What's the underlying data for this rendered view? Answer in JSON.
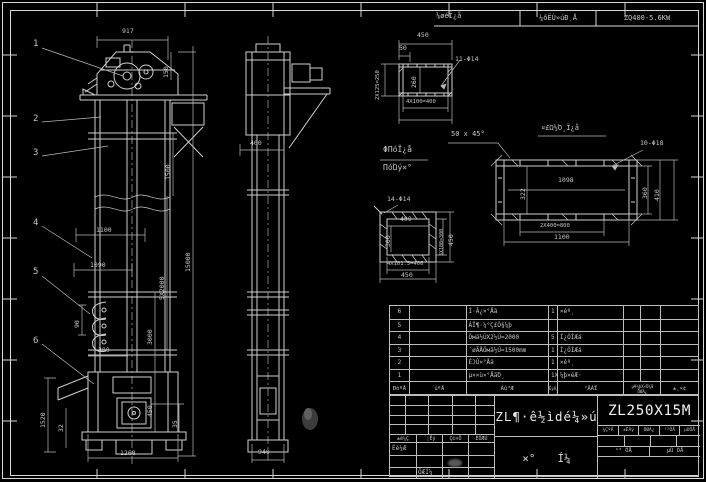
{
  "colors": {
    "background": "#000000",
    "line": "#d0d0d0",
    "dim_text": "#c6c6c6",
    "bright_text": "#f0f0f0"
  },
  "top_strip": {
    "note_left": "⅛øéÏ¿å",
    "gearbox_label": "¼õËÙ»úÐͺÅ",
    "gearbox_model": "ZQ400-5.6KW"
  },
  "parts_table": {
    "headers": {
      "no": "ÐòºÅ",
      "code": "´úºÅ",
      "name": "Ãû³Æ",
      "qty": "ÊýÁ¿",
      "material": "²ÄÁÏ",
      "weight_top": "µ¥¼þX×Ü¼Æ",
      "weight_bottom": "ÖØÁ¿",
      "remark": "±¸×¢"
    },
    "rows": [
      {
        "no": "6",
        "code": "",
        "name": "Í·Â¿×°Åä",
        "qty": "1",
        "material": "×éº¸",
        "remark": ""
      },
      {
        "no": "5",
        "code": "",
        "name": "ÁÏ¶·¼°Ç£Ò§¼þ",
        "qty": "",
        "material": "",
        "remark": ""
      },
      {
        "no": "4",
        "code": "",
        "name": "Öмä½ÚX2½Ú=2000",
        "qty": "5",
        "material": "Í¿ÓÍÆá",
        "remark": ""
      },
      {
        "no": "3",
        "code": "",
        "name": "´øÃÅÖмä½Ú=1500mm",
        "qty": "1",
        "material": "Í¿ÓÍÆá",
        "remark": ""
      },
      {
        "no": "2",
        "code": "",
        "name": "ÉϽÚ×°Åä",
        "qty": "1",
        "material": "×éº¸",
        "remark": ""
      },
      {
        "no": "1",
        "code": "",
        "name": "µ××ù×°ÅäΌ¸",
        "qty": "1X",
        "material": "¼þ×éÆ·",
        "remark": ""
      }
    ]
  },
  "title_block": {
    "rev_labels": [
      "±ê¼Ç",
      "´¦Êý",
      "Ç©×Ö",
      "ÈÕÆÚ"
    ],
    "designer_label": "Éè¼Æ",
    "draft_label": "ÖÆÍ¼",
    "title": "ZL¶·ê½ìdé¼»ú",
    "char_left": "×°",
    "char_right": "Í¼",
    "model": "ZL250X15M",
    "info_cells": [
      "¼ÇºÅ",
      "±ÈÀý",
      "ÖØÁ¿",
      "¹²ÕÅ",
      "µÚÕÅ"
    ],
    "sheet_left": "¹² ÕÅ",
    "sheet_right": "µÚ ÕÅ"
  },
  "annotations": [
    {
      "name": "balloon-1",
      "text": "1",
      "x": 33,
      "y": 40,
      "fs": 9
    },
    {
      "name": "balloon-2",
      "text": "2",
      "x": 33,
      "y": 115,
      "fs": 9
    },
    {
      "name": "balloon-3",
      "text": "3",
      "x": 33,
      "y": 149,
      "fs": 9
    },
    {
      "name": "balloon-4",
      "text": "4",
      "x": 33,
      "y": 219,
      "fs": 9
    },
    {
      "name": "balloon-5",
      "text": "5",
      "x": 33,
      "y": 268,
      "fs": 9
    },
    {
      "name": "balloon-6",
      "text": "6",
      "x": 33,
      "y": 337,
      "fs": 9
    },
    {
      "name": "dim-917",
      "text": "917",
      "x": 122,
      "y": 28
    },
    {
      "name": "dim-150",
      "text": "150",
      "x": 163,
      "y": 78,
      "rot": 1
    },
    {
      "name": "dim-1500",
      "text": "1500",
      "x": 165,
      "y": 180,
      "rot": 1
    },
    {
      "name": "dim-15000",
      "text": "15000",
      "x": 185,
      "y": 272,
      "rot": 1
    },
    {
      "name": "dim-5x2000",
      "text": "5X2000",
      "x": 159,
      "y": 300,
      "rot": 1
    },
    {
      "name": "dim-3000",
      "text": "3000",
      "x": 147,
      "y": 345,
      "rot": 1
    },
    {
      "name": "dim-450-front",
      "text": "450",
      "x": 147,
      "y": 417,
      "rot": 1
    },
    {
      "name": "dim-35",
      "text": "35",
      "x": 172,
      "y": 428,
      "rot": 1
    },
    {
      "name": "dim-1100",
      "text": "1100",
      "x": 96,
      "y": 227
    },
    {
      "name": "dim-1090",
      "text": "1090",
      "x": 90,
      "y": 262
    },
    {
      "name": "dim-90",
      "text": "90",
      "x": 74,
      "y": 328,
      "rot": 1
    },
    {
      "name": "dim-300",
      "text": "300",
      "x": 98,
      "y": 347
    },
    {
      "name": "dim-1520",
      "text": "1520",
      "x": 40,
      "y": 428,
      "rot": 1
    },
    {
      "name": "dim-32",
      "text": "32",
      "x": 58,
      "y": 432,
      "rot": 1
    },
    {
      "name": "dim-1268",
      "text": "1268",
      "x": 120,
      "y": 450
    },
    {
      "name": "dim-400-side",
      "text": "400",
      "x": 250,
      "y": 140
    },
    {
      "name": "dim-940",
      "text": "940",
      "x": 258,
      "y": 449
    },
    {
      "name": "dim-450-d1",
      "text": "450",
      "x": 417,
      "y": 32
    },
    {
      "name": "dim-50-d1",
      "text": "50",
      "x": 399,
      "y": 45
    },
    {
      "name": "dim-2x125",
      "text": "2X125=250",
      "x": 376,
      "y": 100,
      "rot": 1,
      "fs": 5.5
    },
    {
      "name": "dim-260",
      "text": "260",
      "x": 411,
      "y": 88,
      "rot": 1
    },
    {
      "name": "label-11-phi14",
      "text": "11-Φ14",
      "x": 455,
      "y": 56
    },
    {
      "name": "dim-4x100",
      "text": "4X100=400",
      "x": 406,
      "y": 100,
      "fs": 5.5
    },
    {
      "name": "note-line1",
      "text": "ΦΠóΪ¿å",
      "x": 383,
      "y": 146,
      "fs": 8
    },
    {
      "name": "note-line2",
      "text": "ΠόΏý×°",
      "x": 383,
      "y": 164,
      "fs": 8
    },
    {
      "name": "label-14-phi14",
      "text": "14-Φ14",
      "x": 387,
      "y": 196
    },
    {
      "name": "label-chamfer",
      "text": "50 x 45°",
      "x": 451,
      "y": 131,
      "fs": 7
    },
    {
      "name": "note-longpart",
      "text": "¤£Ω½Ό¸Ï¿å",
      "x": 541,
      "y": 125,
      "fs": 7
    },
    {
      "name": "dim-400-sq",
      "text": "400",
      "x": 400,
      "y": 216
    },
    {
      "name": "dim-300-sq",
      "text": "300",
      "x": 385,
      "y": 247,
      "rot": 1
    },
    {
      "name": "dim-3x100",
      "text": "3X100=300",
      "x": 440,
      "y": 256,
      "rot": 1,
      "fs": 5
    },
    {
      "name": "dim-450-sq-right",
      "text": "450",
      "x": 448,
      "y": 246,
      "rot": 1
    },
    {
      "name": "dim-4x1015",
      "text": "4X101.5=406",
      "x": 387,
      "y": 262,
      "fs": 5.5
    },
    {
      "name": "dim-450-sq-bottom",
      "text": "450",
      "x": 401,
      "y": 272
    },
    {
      "name": "label-10-phi18",
      "text": "10-Φ18",
      "x": 640,
      "y": 140
    },
    {
      "name": "dim-1098",
      "text": "1098",
      "x": 558,
      "y": 177
    },
    {
      "name": "dim-322",
      "text": "322",
      "x": 520,
      "y": 200,
      "rot": 1
    },
    {
      "name": "dim-2x400",
      "text": "2X400=800",
      "x": 540,
      "y": 224,
      "fs": 5.5
    },
    {
      "name": "dim-1100-part",
      "text": "1100",
      "x": 554,
      "y": 234
    },
    {
      "name": "dim-360",
      "text": "360",
      "x": 642,
      "y": 199,
      "rot": 1
    },
    {
      "name": "dim-410",
      "text": "410",
      "x": 654,
      "y": 201,
      "rot": 1
    }
  ]
}
